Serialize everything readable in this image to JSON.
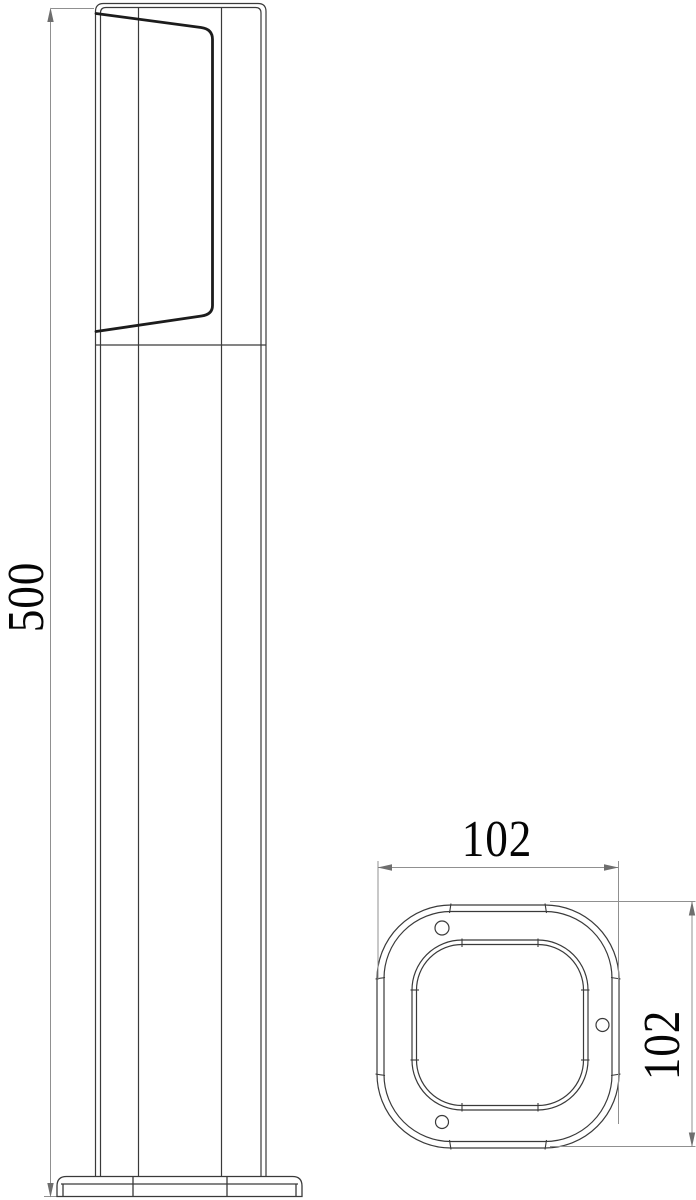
{
  "front_view": {
    "height_dim": {
      "label": "500"
    }
  },
  "plan_view": {
    "width_dim": {
      "label": "102"
    },
    "depth_dim": {
      "label": "102"
    }
  },
  "colors": {
    "background": "#ffffff",
    "object_line": "#3a3a3a",
    "thick_line": "#1c1c1c",
    "dimension_line": "#909090",
    "arrow": "#6e6e6e",
    "text": "#050505"
  }
}
